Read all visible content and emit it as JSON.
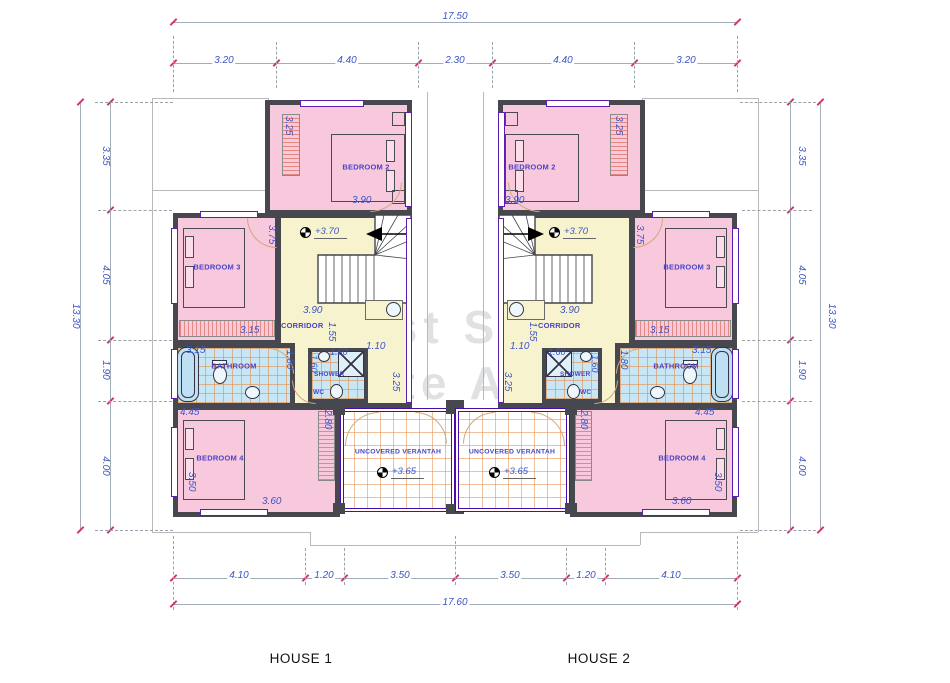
{
  "watermark": {
    "line1": "Fast Smart",
    "line2": "Estate Agency"
  },
  "houses": [
    {
      "label": "HOUSE 1"
    },
    {
      "label": "HOUSE 2"
    }
  ],
  "dims": {
    "top": {
      "overall": "17.50",
      "segments": [
        "3.20",
        "4.40",
        "2.30",
        "4.40",
        "3.20"
      ]
    },
    "bottom": {
      "overall": "17.60",
      "segments": [
        "4.10",
        "1.20",
        "3.50",
        "3.50",
        "1.20",
        "4.10"
      ]
    },
    "left": {
      "overall": "13.30",
      "segments": [
        "3.35",
        "4.05",
        "1.90",
        "4.00"
      ]
    },
    "right": {
      "overall": "13.30",
      "segments": [
        "3.35",
        "4.05",
        "1.90",
        "4.00"
      ]
    }
  },
  "rooms": {
    "bedroom2": {
      "label": "BEDROOM 2",
      "width": "3.90",
      "side": "3.25"
    },
    "bedroom3": {
      "label": "BEDROOM 3",
      "width": "3.15",
      "door": "3.75"
    },
    "bedroom4": {
      "label": "BEDROOM 4",
      "top": "4.45",
      "bottom": "3.60",
      "left": "3.50",
      "right": "2.80"
    },
    "bathroom": {
      "label": "BATHROOM",
      "width": "3.15",
      "height": "1.80"
    },
    "shower": {
      "label": "SHOWER",
      "width": "1.60",
      "depth": "1.60"
    },
    "wc": {
      "label": "WC"
    },
    "corridor": {
      "label": "CORRIDOR",
      "length": "1.55",
      "width": "1.10",
      "stair": "3.90",
      "door": "3.25",
      "level": "+3.70"
    },
    "veranda": {
      "label": "UNCOVERED VERANTAH",
      "level": "+3.65"
    }
  },
  "colors": {
    "wall": "#47474f",
    "bedroom_fill": "#f8c9dd",
    "corridor_fill": "#f7f3cf",
    "bathroom_fill": "#c9e6f4",
    "tile_grid": "#e09658",
    "veranda_border": "#4b0ba8",
    "dimension_text": "#3d55c4",
    "tick": "#d6336c"
  }
}
